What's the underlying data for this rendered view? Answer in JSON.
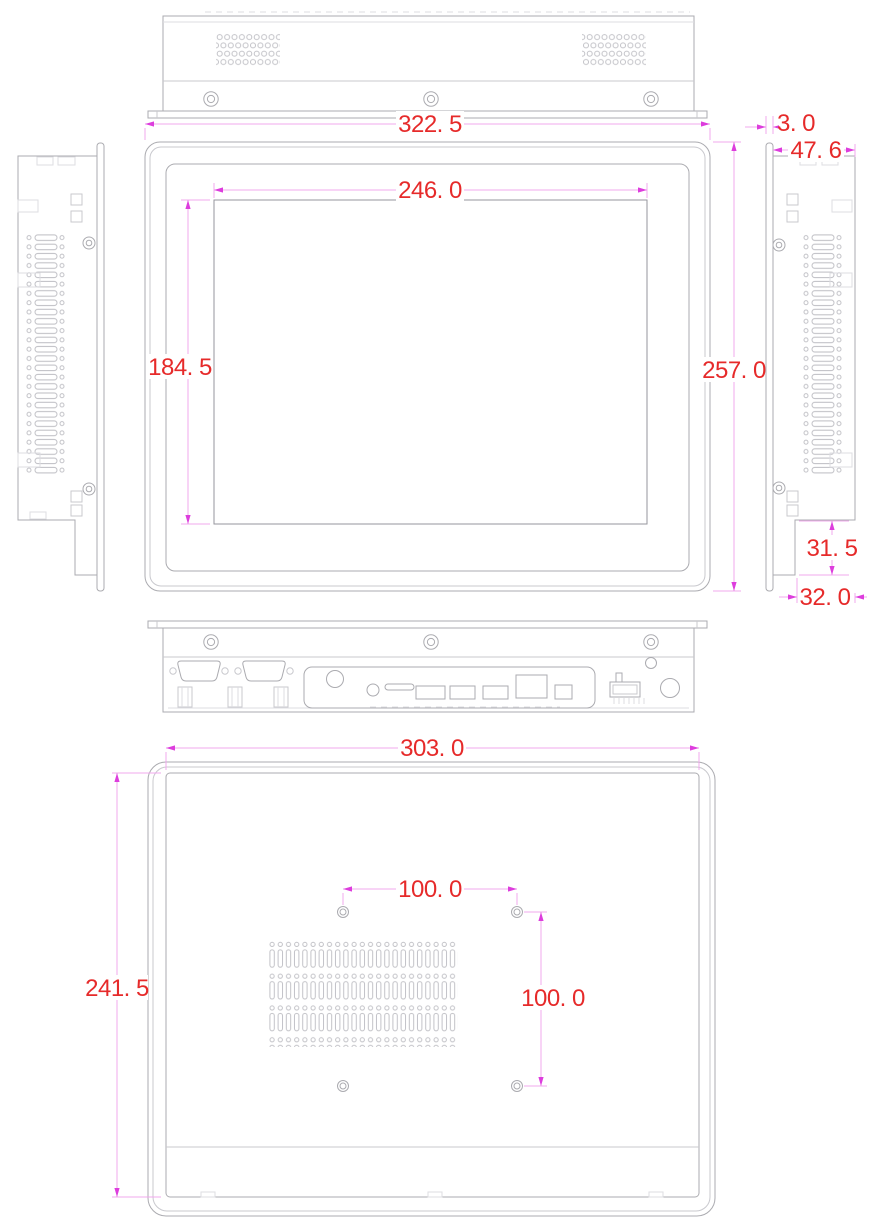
{
  "colors": {
    "outline": "#ababb0",
    "outline_light": "#c9c9ce",
    "dimension_line": "#f0a8ed",
    "dimension_arrow": "#dd3ddd",
    "dimension_text": "#e62a2a",
    "background": "#ffffff"
  },
  "dimensions": {
    "front_overall_width": "322. 5",
    "display_area_width": "246. 0",
    "display_area_height": "184. 5",
    "front_overall_height": "257. 0",
    "front_bezel_protrusion": "3. 0",
    "overall_depth": "47. 6",
    "rear_step_height": "31. 5",
    "rear_step_depth": "32. 0",
    "rear_body_width": "303. 0",
    "rear_body_height": "241. 5",
    "vesa_hole_spacing_horizontal": "100. 0",
    "vesa_hole_spacing_vertical": "100. 0"
  }
}
